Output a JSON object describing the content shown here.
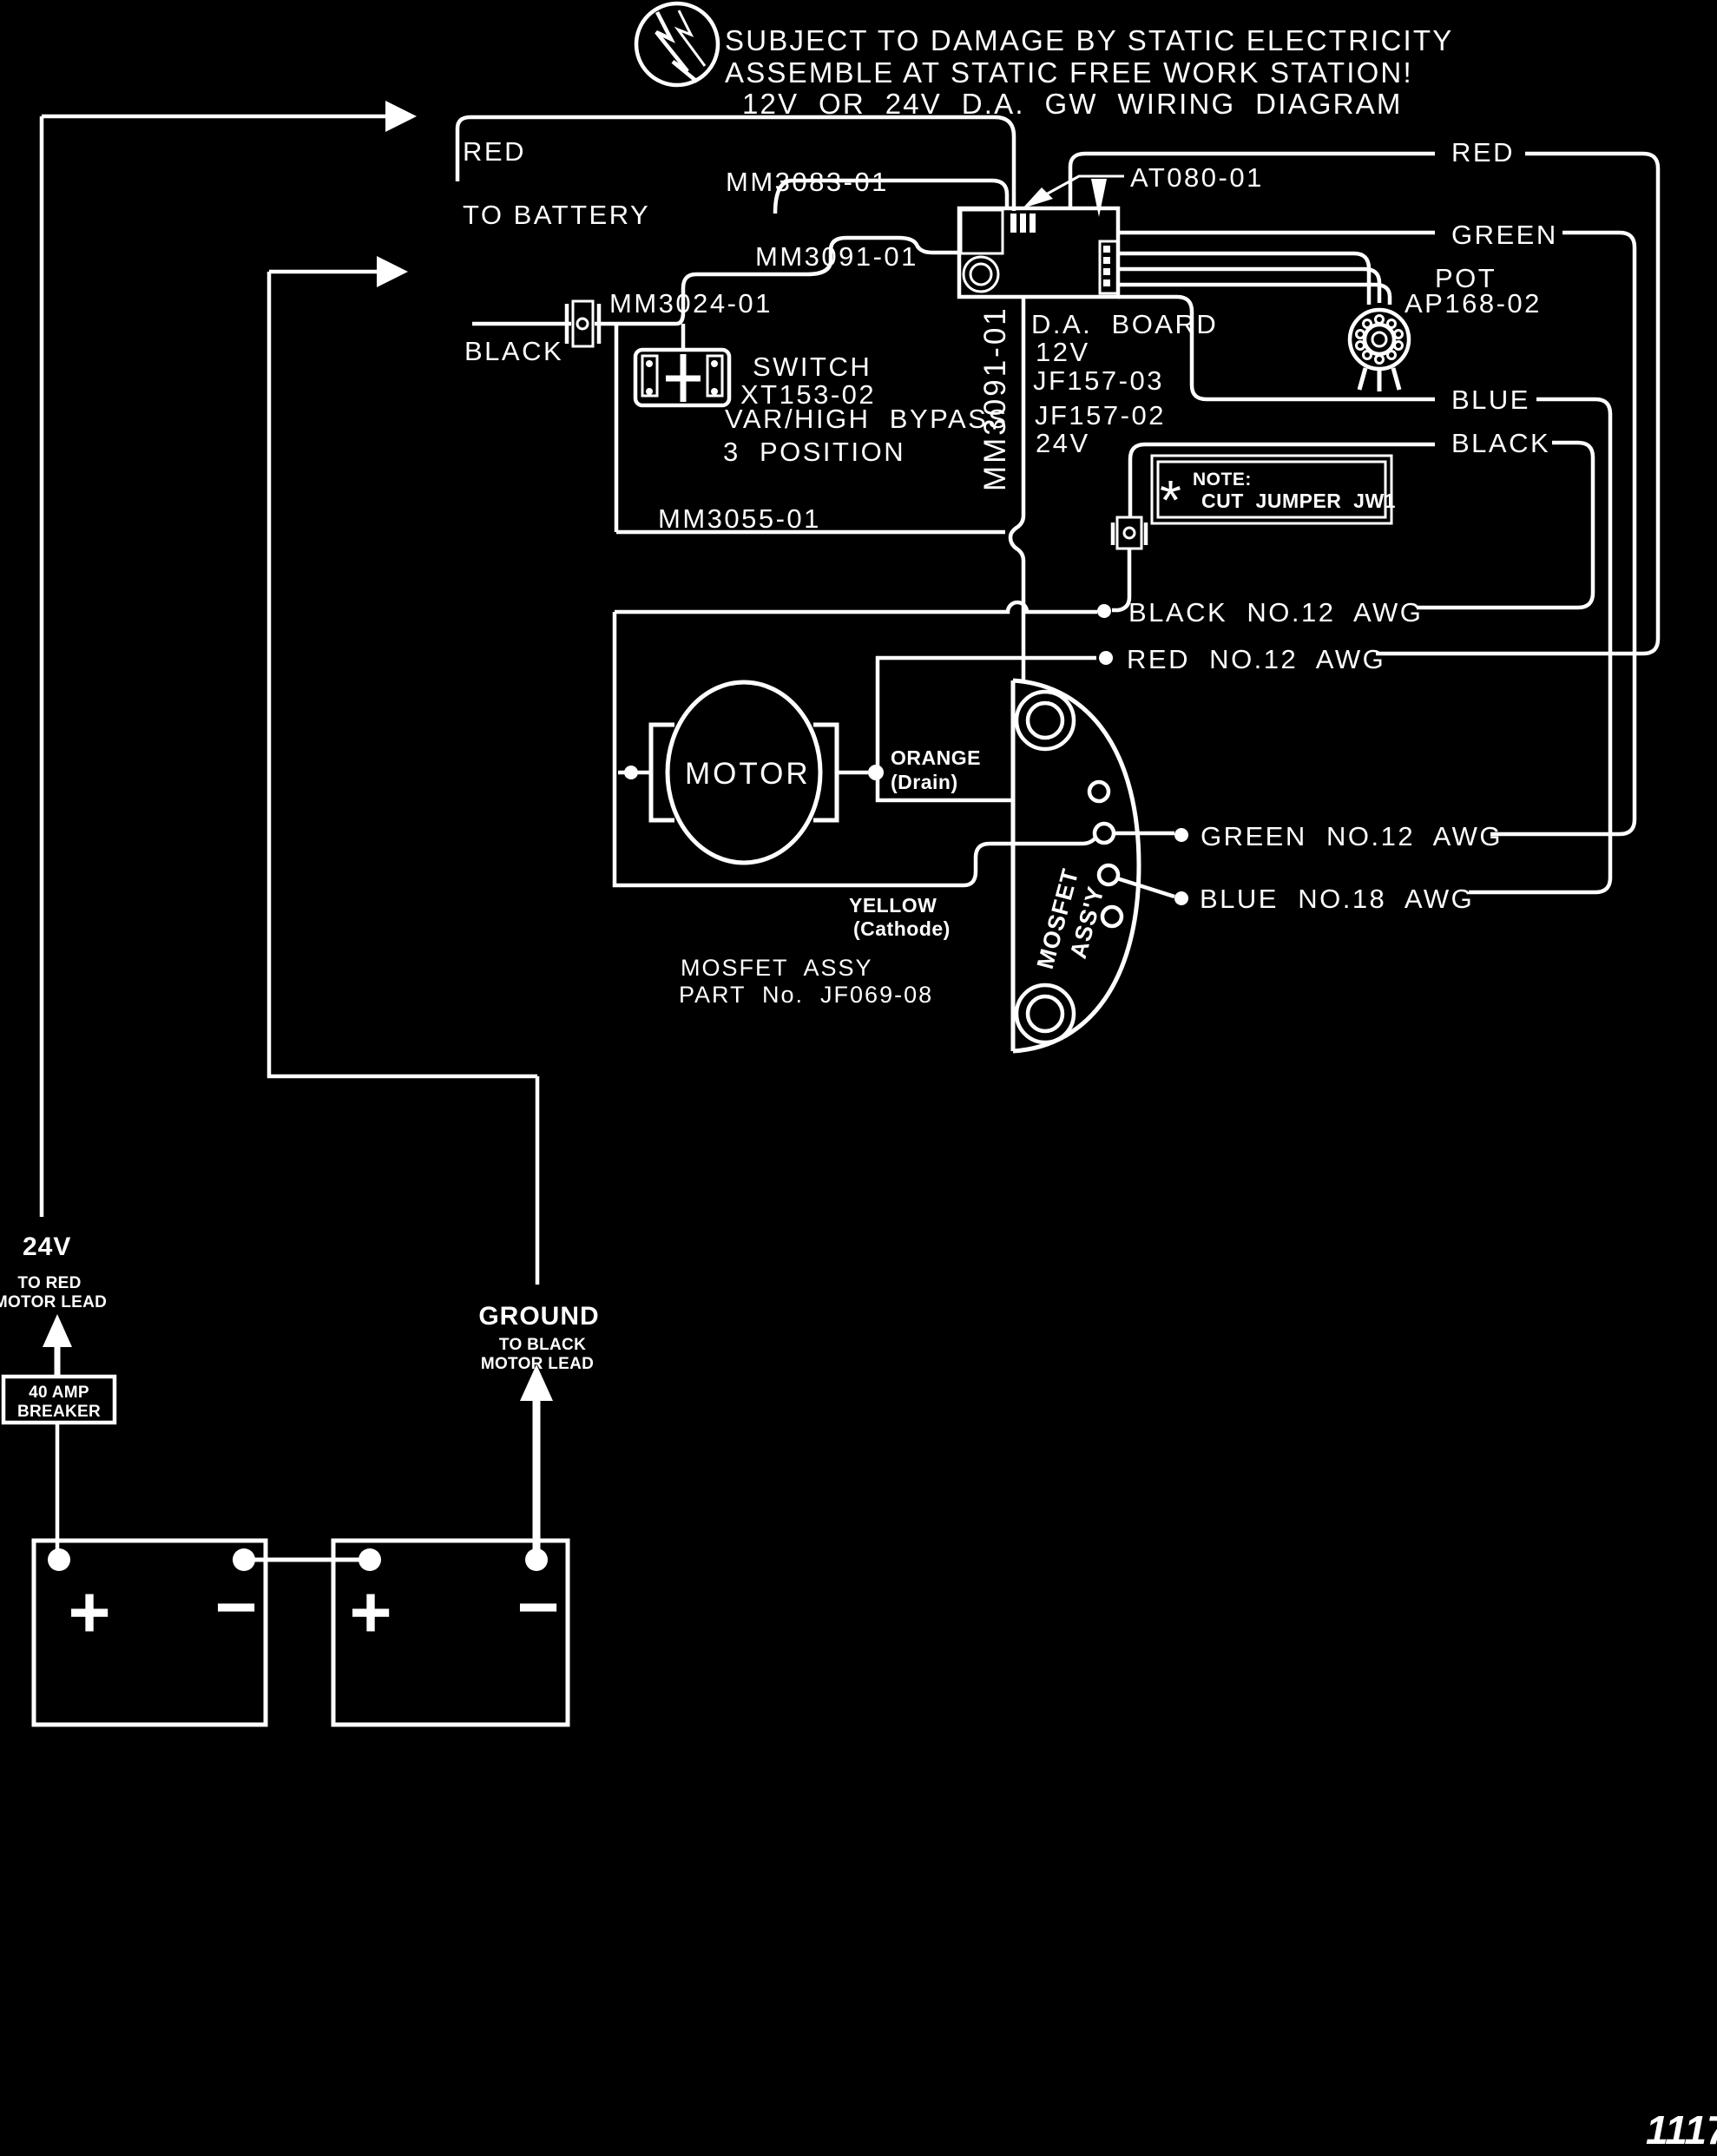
{
  "page": {
    "background": "#000000",
    "line_color": "#ffffff",
    "page_number": "1117"
  },
  "header": {
    "icon": "static-electricity-icon",
    "line1": "SUBJECT TO DAMAGE BY STATIC ELECTRICITY",
    "line2": "ASSEMBLE AT STATIC FREE WORK STATION!",
    "line3": "12V  OR  24V  D.A.  GW  WIRING  DIAGRAM"
  },
  "battery_feed": {
    "red_label": "RED",
    "to_battery": "TO BATTERY",
    "black_label": "BLACK"
  },
  "harness": {
    "mm3083": "MM3083-01",
    "mm3091_top": "MM3091-01",
    "mm3024": "MM3024-01",
    "mm3055": "MM3055-01",
    "mm3091_vertical": "MM3091-01"
  },
  "switch": {
    "title": "SWITCH",
    "part": "XT153-02",
    "mode": "VAR/HIGH  BYPASS",
    "positions": "3  POSITION"
  },
  "connector": {
    "part": "AT080-01"
  },
  "da_board": {
    "title": "D.A.  BOARD",
    "v12": "12V",
    "part_12v": "JF157-03",
    "part_24v": "JF157-02",
    "v24": "24V"
  },
  "pot": {
    "label": "POT",
    "part": "AP168-02"
  },
  "wire_labels_right": {
    "red": "RED",
    "green": "GREEN",
    "blue": "BLUE",
    "black": "BLACK"
  },
  "note": {
    "star": "*",
    "title": "NOTE:",
    "body": "CUT  JUMPER  JW1"
  },
  "awg": {
    "black": "BLACK  NO.12  AWG",
    "red": "RED  NO.12  AWG",
    "green": "GREEN  NO.12  AWG",
    "blue": "BLUE  NO.18  AWG"
  },
  "motor": {
    "label": "MOTOR",
    "orange": "ORANGE",
    "orange_sub": "(Drain)",
    "yellow": "YELLOW",
    "yellow_sub": "(Cathode)"
  },
  "mosfet": {
    "assy": "MOSFET  ASSY",
    "part": "PART  No.  JF069-08",
    "vertical_1": "MOSFET",
    "vertical_2": "ASS'Y"
  },
  "battery_bank": {
    "voltage": "24V",
    "to_red_1": "TO RED",
    "to_red_2": "MOTOR LEAD",
    "breaker_1": "40 AMP",
    "breaker_2": "BREAKER",
    "ground": "GROUND",
    "to_black_1": "TO BLACK",
    "to_black_2": "MOTOR LEAD",
    "plus": "+",
    "minus": "−"
  }
}
